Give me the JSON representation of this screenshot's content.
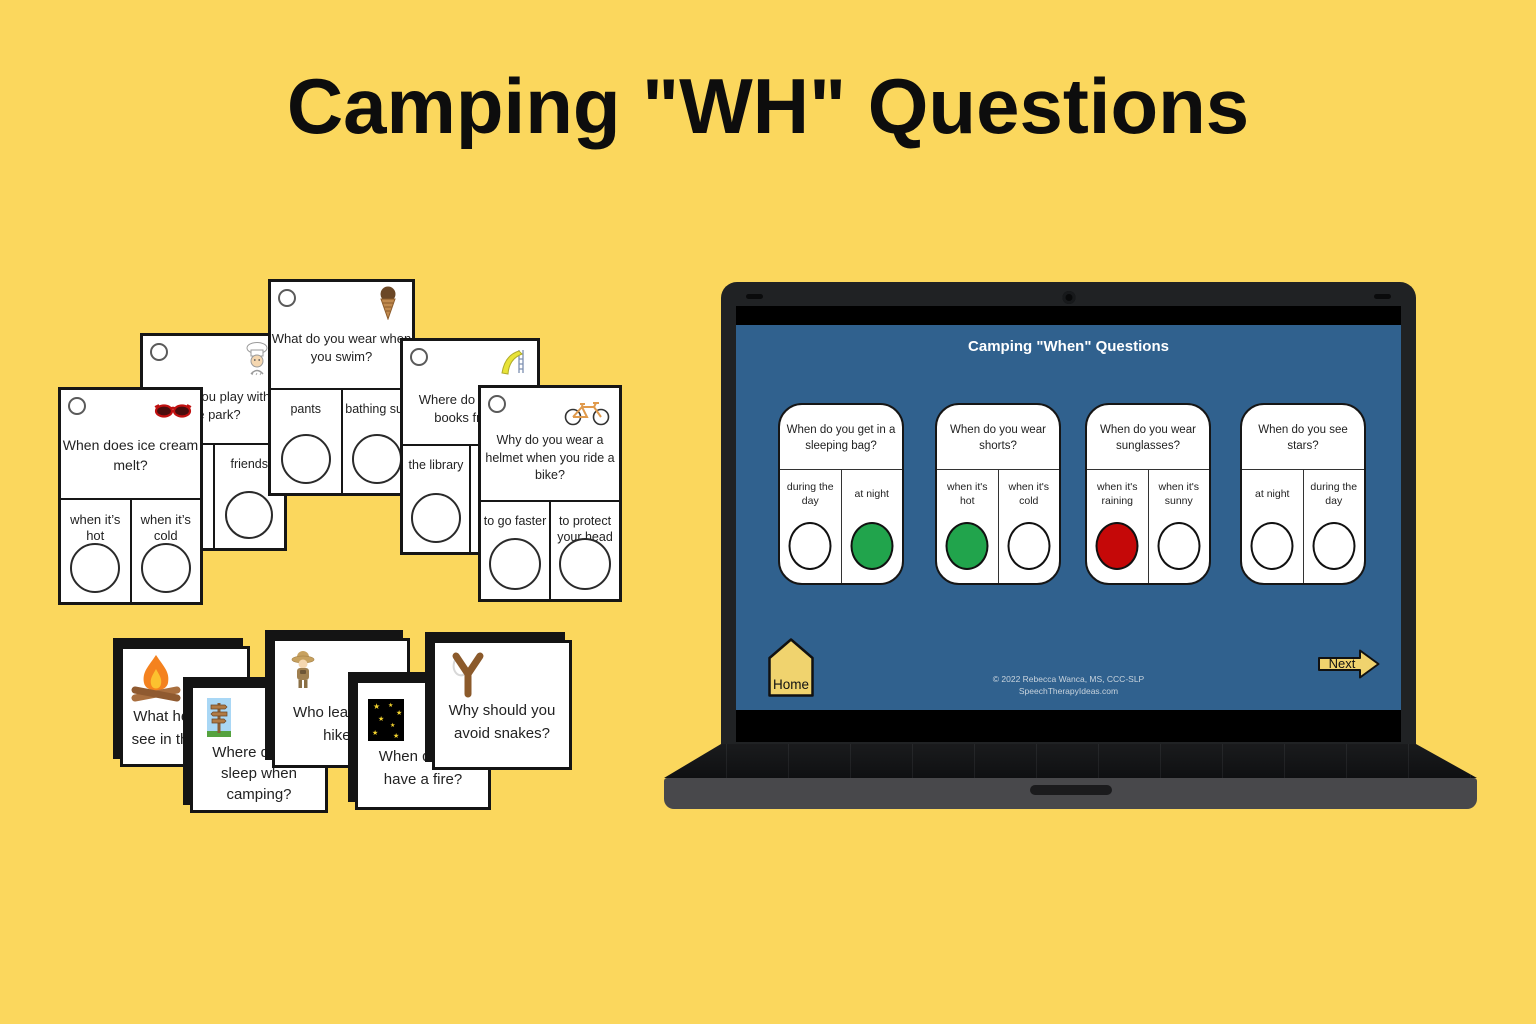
{
  "title": "Camping \"WH\" Questions",
  "print_cards": {
    "large": [
      {
        "question": "When does ice cream\nmelt?",
        "answers": [
          "when it’s\nhot",
          "when it’s\ncold"
        ],
        "icon": "sunglasses"
      },
      {
        "question": "What do you play with at\nthe park?",
        "answers": [
          "",
          "friends"
        ],
        "icon": "chef"
      },
      {
        "question": "What do you wear when\nyou swim?",
        "answers": [
          "pants",
          "bathing suit"
        ],
        "icon": "ice-cream-cone"
      },
      {
        "question": "Where do you get\nbooks from?",
        "answers": [
          "the library",
          ""
        ],
        "icon": "slide"
      },
      {
        "question": "Why do you wear a\nhelmet when you ride a\nbike?",
        "answers": [
          "to go faster",
          "to protect\nyour head"
        ],
        "icon": "bicycle"
      }
    ],
    "small": [
      {
        "question": "What helps you\nsee in the dark?",
        "icon": "campfire"
      },
      {
        "question": "Where do you\nsleep when\ncamping?",
        "icon": "signpost"
      },
      {
        "question": "Who leads the\nhike?",
        "icon": "hiker"
      },
      {
        "question": "When do you\nhave a fire?",
        "icon": "night-stars"
      },
      {
        "question": "Why should you\navoid snakes?",
        "icon": "slingshot"
      }
    ]
  },
  "laptop": {
    "slide_title": "Camping \"When\" Questions",
    "cards": [
      {
        "question": "When do you get in a\nsleeping bag?",
        "answers": [
          {
            "label": "during the\nday",
            "fill": "#FFFFFF"
          },
          {
            "label": "at night",
            "fill": "#21A44C"
          }
        ]
      },
      {
        "question": "When do you wear\nshorts?",
        "answers": [
          {
            "label": "when it's\nhot",
            "fill": "#21A44C"
          },
          {
            "label": "when it's\ncold",
            "fill": "#FFFFFF"
          }
        ]
      },
      {
        "question": "When do you wear\nsunglasses?",
        "answers": [
          {
            "label": "when it's\nraining",
            "fill": "#C50808"
          },
          {
            "label": "when it's\nsunny",
            "fill": "#FFFFFF"
          }
        ]
      },
      {
        "question": "When do you see\nstars?",
        "answers": [
          {
            "label": "at night",
            "fill": "#FFFFFF"
          },
          {
            "label": "during the\nday",
            "fill": "#FFFFFF"
          }
        ]
      }
    ],
    "home_label": "Home",
    "next_label": "Next",
    "footer_line1": "© 2022 Rebecca Wanca, MS, CCC-SLP",
    "footer_line2": "SpeechTherapyIdeas.com"
  },
  "colors": {
    "background": "#FBD75D",
    "screen_blue": "#30618E",
    "correct_green": "#21A44C",
    "incorrect_red": "#C50808",
    "button_yellow": "#F0D36E"
  }
}
